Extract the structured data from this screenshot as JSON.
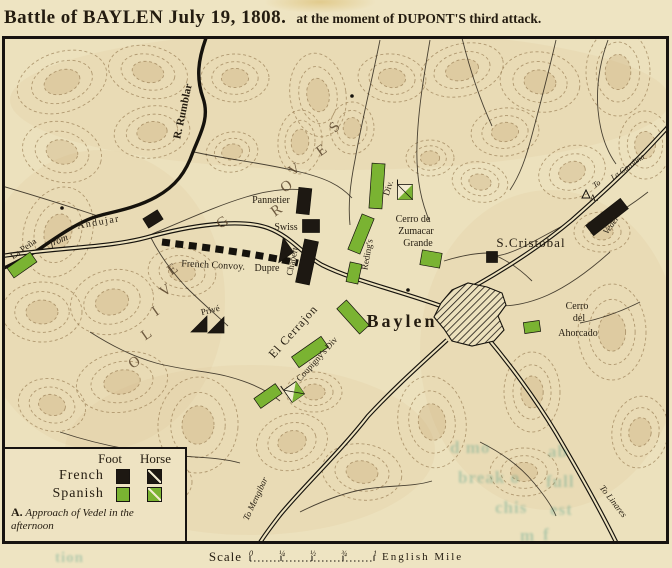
{
  "title": {
    "main": "Battle of BAYLEN July 19, 1808.",
    "sub": "at the moment of DUPONT'S third attack."
  },
  "colors": {
    "paper": "#ece1bd",
    "ink": "#15120c",
    "label_ink": "#241c10",
    "hill_ink": "#5a452c",
    "terrain_stroke": "#8d6f45",
    "terrain_fill": "#c2a26e",
    "french_black": "#1d1812",
    "spanish_green": "#7ab332",
    "bleed_teal": "#2f8f7d"
  },
  "legend": {
    "col_foot": "Foot",
    "col_horse": "Horse",
    "rows": [
      {
        "label": "French",
        "color": "#1d1812"
      },
      {
        "label": "Spanish",
        "color": "#7ab332"
      }
    ],
    "note_marker": "A.",
    "note_line1": "Approach of Vedel in the",
    "note_line2": "afternoon"
  },
  "scale_bar": {
    "label": "Scale",
    "ticks": [
      "0",
      "¼",
      "½",
      "¾",
      "1"
    ],
    "unit": "English Mile"
  },
  "map": {
    "hills": [
      [
        62,
        82,
        46,
        30,
        -18
      ],
      [
        148,
        72,
        40,
        26,
        12
      ],
      [
        235,
        78,
        34,
        24,
        0
      ],
      [
        318,
        95,
        28,
        42,
        -8
      ],
      [
        392,
        78,
        34,
        24,
        6
      ],
      [
        462,
        70,
        42,
        26,
        -14
      ],
      [
        540,
        82,
        40,
        30,
        8
      ],
      [
        618,
        72,
        32,
        44,
        0
      ],
      [
        645,
        145,
        26,
        34,
        0
      ],
      [
        505,
        132,
        34,
        24,
        -6
      ],
      [
        572,
        172,
        34,
        26,
        -18
      ],
      [
        480,
        182,
        28,
        20,
        10
      ],
      [
        430,
        158,
        24,
        18,
        0
      ],
      [
        300,
        142,
        22,
        32,
        4
      ],
      [
        232,
        152,
        26,
        20,
        -10
      ],
      [
        62,
        152,
        40,
        30,
        14
      ],
      [
        152,
        132,
        38,
        26,
        -8
      ],
      [
        58,
        232,
        34,
        46,
        18
      ],
      [
        42,
        312,
        40,
        30,
        0
      ],
      [
        112,
        302,
        42,
        32,
        -14
      ],
      [
        182,
        272,
        34,
        24,
        8
      ],
      [
        122,
        382,
        46,
        30,
        -10
      ],
      [
        52,
        405,
        34,
        26,
        14
      ],
      [
        198,
        425,
        40,
        48,
        4
      ],
      [
        292,
        442,
        36,
        28,
        -16
      ],
      [
        362,
        472,
        40,
        28,
        8
      ],
      [
        152,
        482,
        40,
        26,
        0
      ],
      [
        314,
        392,
        28,
        20,
        0
      ],
      [
        432,
        422,
        34,
        46,
        -8
      ],
      [
        532,
        392,
        28,
        40,
        0
      ],
      [
        612,
        332,
        34,
        48,
        0
      ],
      [
        640,
        432,
        28,
        36,
        8
      ],
      [
        524,
        472,
        34,
        24,
        0
      ],
      [
        602,
        232,
        28,
        20,
        0
      ],
      [
        352,
        128,
        22,
        26,
        0
      ]
    ],
    "river": {
      "name": "R. Rumblar",
      "d": "M206,38 C198,60 196,78 203,98 C210,118 200,134 193,152 C186,172 176,186 156,197 C136,208 116,211 98,216 C80,221 58,236 38,250 C22,260 10,265 2,269"
    },
    "roads": [
      {
        "name": "road-from-andujar",
        "d": "M2,256 C60,247 112,248 152,236 C205,222 246,220 268,228 C292,237 302,254 322,265 C352,280 396,290 441,306"
      },
      {
        "name": "road-to-la-carolina",
        "d": "M450,299 C492,278 540,247 572,220 C598,197 626,172 654,142 L668,127"
      },
      {
        "name": "road-to-linares",
        "d": "M468,316 C498,348 532,393 556,433 C576,467 600,509 618,546"
      },
      {
        "name": "road-to-mengibar",
        "d": "M447,340 C420,365 396,386 368,416 C340,452 302,488 280,515 C270,528 263,537 258,546"
      }
    ],
    "streams": [
      "M194,152 C230,160 265,163 300,172 C325,178 340,185 352,198",
      "M380,40 C372,80 362,120 355,160 C350,185 348,205 350,225",
      "M430,40 C424,75 418,110 417,145 C416,175 420,200 430,222",
      "M556,40 C548,75 540,105 532,135 C526,158 520,175 510,190",
      "M608,40 C600,62 596,86 598,110 C600,132 606,150 616,164",
      "M648,192 C630,206 614,216 600,223",
      "M610,252 C590,270 570,285 548,295 C530,303 514,306 500,306",
      "M640,302 C620,312 600,319 580,323",
      "M90,332 C112,346 132,356 156,363 C182,370 206,371 226,376 C250,382 268,391 280,401",
      "M60,432 C90,442 122,449 152,453 C186,458 216,456 240,463",
      "M100,546 C120,514 150,486 180,462",
      "M300,512 C320,502 342,493 366,489 C392,485 412,487 432,481",
      "M480,442 C500,452 520,466 534,483 C544,495 552,506 556,516",
      "M152,234 C186,220 216,206 246,197 C266,191 286,188 303,190",
      "M2,186 C36,196 68,206 98,216",
      "M150,236 C160,256 172,272 186,287 C200,301 214,313 228,326",
      "M444,261 C460,256 476,253 489,253",
      "M489,253 C506,259 520,269 532,281",
      "M574,220 C556,229 539,239 523,247 C506,255 496,257 489,256",
      "M462,38 C470,70 480,100 492,126"
    ],
    "convoy": {
      "name": "french-convoy-dashes",
      "d": "M162,242 C200,247 240,251 298,263"
    },
    "town": {
      "name": "Baylen-town",
      "points": "441,303 452,290 468,283 487,287 502,293 506,305 498,316 504,330 494,341 472,346 452,341 444,329 434,317"
    },
    "units": [
      {
        "name": "pannetier-unit",
        "type": "foot",
        "side": "french",
        "x": 304,
        "y": 201,
        "w": 13,
        "h": 26,
        "rot": 6
      },
      {
        "name": "swiss-unit",
        "type": "foot",
        "side": "french",
        "x": 311,
        "y": 226,
        "w": 17,
        "h": 13,
        "rot": 0
      },
      {
        "name": "chabert-unit",
        "type": "foot",
        "side": "french",
        "x": 307,
        "y": 262,
        "w": 14,
        "h": 44,
        "rot": 12
      },
      {
        "name": "road-junction-unit",
        "type": "foot",
        "side": "french",
        "x": 153,
        "y": 219,
        "w": 17,
        "h": 11,
        "rot": -32
      },
      {
        "name": "vedel-unit",
        "type": "foot",
        "side": "french",
        "x": 607,
        "y": 217,
        "w": 44,
        "h": 13,
        "rot": -38
      },
      {
        "name": "dupre-unit",
        "type": "tri",
        "side": "french",
        "x": 281,
        "y": 250,
        "s": 18,
        "rot": -35
      },
      {
        "name": "prive-cavalry-1",
        "type": "tri",
        "side": "french",
        "x": 199,
        "y": 324,
        "s": 16,
        "rot": 0
      },
      {
        "name": "prive-cavalry-2",
        "type": "tri",
        "side": "french",
        "x": 216,
        "y": 325,
        "s": 16,
        "rot": 0
      },
      {
        "name": "s-cristobal-building",
        "type": "foot",
        "side": "french",
        "x": 492,
        "y": 257,
        "w": 11,
        "h": 11,
        "rot": 0
      },
      {
        "name": "la-pena-unit",
        "type": "foot",
        "side": "spanish",
        "x": 22,
        "y": 265,
        "w": 28,
        "h": 12,
        "rot": -35
      },
      {
        "name": "reding-unit-1",
        "type": "foot",
        "side": "spanish",
        "x": 377,
        "y": 186,
        "w": 13,
        "h": 45,
        "rot": 4
      },
      {
        "name": "reding-cavalry",
        "type": "cav",
        "side": "spanish",
        "x": 405,
        "y": 192,
        "s": 15,
        "rot": 0
      },
      {
        "name": "reding-unit-2",
        "type": "foot",
        "side": "spanish",
        "x": 361,
        "y": 234,
        "w": 13,
        "h": 38,
        "rot": 22
      },
      {
        "name": "reding-unit-3",
        "type": "foot",
        "side": "spanish",
        "x": 354,
        "y": 273,
        "w": 12,
        "h": 20,
        "rot": 12
      },
      {
        "name": "zumacar-unit",
        "type": "foot",
        "side": "spanish",
        "x": 431,
        "y": 259,
        "w": 20,
        "h": 15,
        "rot": 10
      },
      {
        "name": "baylen-west-unit",
        "type": "foot",
        "side": "spanish",
        "x": 353,
        "y": 317,
        "w": 13,
        "h": 34,
        "rot": -42
      },
      {
        "name": "coupigny-unit-1",
        "type": "foot",
        "side": "spanish",
        "x": 310,
        "y": 352,
        "w": 36,
        "h": 13,
        "rot": -35
      },
      {
        "name": "coupigny-unit-2",
        "type": "foot",
        "side": "spanish",
        "x": 268,
        "y": 396,
        "w": 26,
        "h": 12,
        "rot": -35
      },
      {
        "name": "coupigny-cavalry",
        "type": "cav",
        "side": "spanish",
        "x": 294,
        "y": 392,
        "s": 15,
        "rot": -35
      },
      {
        "name": "ahorcado-unit",
        "type": "foot",
        "side": "spanish",
        "x": 532,
        "y": 327,
        "w": 16,
        "h": 11,
        "rot": -8
      }
    ],
    "dots": [
      [
        408,
        290
      ],
      [
        62,
        208
      ],
      [
        352,
        96
      ]
    ],
    "marker_a": {
      "x": 586,
      "y": 194
    },
    "labels": [
      {
        "text": "R. Rumblar",
        "x": 186,
        "y": 112,
        "rot": -78,
        "size": 11,
        "weight": "bold",
        "name": "label-r-rumblar"
      },
      {
        "text": "from",
        "x": 60,
        "y": 243,
        "rot": -22,
        "size": 10,
        "style": "italic",
        "name": "label-from"
      },
      {
        "text": "Andujar",
        "x": 99,
        "y": 225,
        "rot": -10,
        "size": 10,
        "ls": 1.5,
        "name": "label-andujar"
      },
      {
        "text": "La Peña",
        "x": 25,
        "y": 251,
        "rot": -35,
        "size": 9,
        "name": "label-la-pena"
      },
      {
        "text": "French Convoy.",
        "x": 213,
        "y": 268,
        "rot": 3,
        "size": 10,
        "name": "label-french-convoy"
      },
      {
        "text": "Dupre",
        "x": 267,
        "y": 271,
        "rot": 0,
        "size": 10,
        "name": "label-dupre"
      },
      {
        "text": "Chabert",
        "x": 295,
        "y": 262,
        "rot": -78,
        "size": 9,
        "name": "label-chabert"
      },
      {
        "text": "Swiss",
        "x": 286,
        "y": 230,
        "rot": 0,
        "size": 10,
        "name": "label-swiss"
      },
      {
        "text": "Pannetier",
        "x": 271,
        "y": 203,
        "rot": 0,
        "size": 10,
        "name": "label-pannetier"
      },
      {
        "text": "Privé",
        "x": 211,
        "y": 313,
        "rot": -14,
        "size": 9,
        "name": "label-prive"
      },
      {
        "text": "O",
        "x": 137,
        "y": 366,
        "rot": -35,
        "size": 15,
        "cls": "hill",
        "name": "label-olive-o"
      },
      {
        "text": "L",
        "x": 149,
        "y": 338,
        "rot": -35,
        "size": 15,
        "cls": "hill",
        "name": "label-olive-l"
      },
      {
        "text": "I",
        "x": 158,
        "y": 315,
        "rot": -35,
        "size": 15,
        "cls": "hill",
        "name": "label-olive-i"
      },
      {
        "text": "V",
        "x": 168,
        "y": 294,
        "rot": -35,
        "size": 15,
        "cls": "hill",
        "name": "label-olive-v"
      },
      {
        "text": "E",
        "x": 175,
        "y": 273,
        "rot": -35,
        "size": 15,
        "cls": "hill",
        "name": "label-olive-e"
      },
      {
        "text": "G",
        "x": 225,
        "y": 226,
        "rot": -35,
        "size": 15,
        "cls": "hill",
        "name": "label-groves-g"
      },
      {
        "text": "R",
        "x": 279,
        "y": 214,
        "rot": -35,
        "size": 15,
        "cls": "hill",
        "name": "label-groves-r"
      },
      {
        "text": "O",
        "x": 289,
        "y": 190,
        "rot": -35,
        "size": 15,
        "cls": "hill",
        "name": "label-groves-o"
      },
      {
        "text": "V",
        "x": 297,
        "y": 173,
        "rot": -35,
        "size": 15,
        "cls": "hill",
        "name": "label-groves-v"
      },
      {
        "text": "E",
        "x": 324,
        "y": 154,
        "rot": -35,
        "size": 15,
        "cls": "hill",
        "name": "label-groves-e"
      },
      {
        "text": "S",
        "x": 338,
        "y": 130,
        "rot": -50,
        "size": 15,
        "cls": "hill",
        "name": "label-groves-s"
      },
      {
        "text": "Reding's",
        "x": 370,
        "y": 255,
        "rot": -80,
        "size": 9,
        "name": "label-redings"
      },
      {
        "text": "Div.",
        "x": 391,
        "y": 189,
        "rot": -72,
        "size": 9,
        "name": "label-redings-div"
      },
      {
        "text": "Cerro de",
        "x": 413,
        "y": 222,
        "rot": 0,
        "size": 10,
        "name": "label-cerro-de"
      },
      {
        "text": "Zumacar",
        "x": 416,
        "y": 234,
        "rot": 0,
        "size": 10,
        "name": "label-zumacar"
      },
      {
        "text": "Grande",
        "x": 418,
        "y": 246,
        "rot": 0,
        "size": 10,
        "name": "label-grande"
      },
      {
        "text": "S.Cristobal",
        "x": 531,
        "y": 247,
        "rot": 0,
        "size": 13,
        "ls": 1,
        "name": "label-s-cristobal"
      },
      {
        "text": "Baylen",
        "x": 402,
        "y": 327,
        "rot": 0,
        "size": 18,
        "weight": "bold",
        "ls": 3,
        "name": "label-baylen"
      },
      {
        "text": "El Cerrajon",
        "x": 296,
        "y": 334,
        "rot": -48,
        "size": 12,
        "ls": 1,
        "name": "label-el-cerrajon"
      },
      {
        "text": "Coupigny's Div",
        "x": 319,
        "y": 361,
        "rot": -48,
        "size": 9,
        "name": "label-coupignys-div"
      },
      {
        "text": "Cerro",
        "x": 577,
        "y": 309,
        "rot": 0,
        "size": 10,
        "name": "label-cerro"
      },
      {
        "text": "del",
        "x": 579,
        "y": 321,
        "rot": 0,
        "size": 10,
        "name": "label-del"
      },
      {
        "text": "Ahorcado",
        "x": 578,
        "y": 336,
        "rot": 0,
        "size": 10,
        "name": "label-ahorcado"
      },
      {
        "text": "To",
        "x": 598,
        "y": 186,
        "rot": -35,
        "size": 8,
        "style": "italic",
        "name": "label-to"
      },
      {
        "text": "La Carolina",
        "x": 629,
        "y": 169,
        "rot": -35,
        "size": 8,
        "style": "italic",
        "name": "label-la-carolina"
      },
      {
        "text": "Vedel",
        "x": 613,
        "y": 227,
        "rot": -55,
        "size": 9,
        "style": "italic",
        "name": "label-vedel"
      },
      {
        "text": "A.",
        "x": 594,
        "y": 201,
        "rot": 0,
        "size": 9,
        "name": "label-marker-a"
      },
      {
        "text": "To Linares",
        "x": 611,
        "y": 503,
        "rot": 52,
        "size": 9,
        "style": "italic",
        "name": "label-to-linares"
      },
      {
        "text": "To Mengibar",
        "x": 258,
        "y": 500,
        "rot": -65,
        "size": 9,
        "style": "italic",
        "name": "label-to-mengibar"
      }
    ]
  },
  "bleed_text": [
    {
      "t": "d mo",
      "x": 450,
      "y": 438,
      "size": 17
    },
    {
      "t": "break o",
      "x": 458,
      "y": 468,
      "size": 17
    },
    {
      "t": "chis",
      "x": 495,
      "y": 498,
      "size": 17
    },
    {
      "t": "m",
      "x": 520,
      "y": 526,
      "size": 17
    },
    {
      "t": "ab",
      "x": 548,
      "y": 442,
      "size": 17
    },
    {
      "t": "full",
      "x": 546,
      "y": 472,
      "size": 17
    },
    {
      "t": "est",
      "x": 550,
      "y": 500,
      "size": 17
    },
    {
      "t": "f",
      "x": 543,
      "y": 525,
      "size": 17
    },
    {
      "t": "tion",
      "x": 55,
      "y": 550,
      "size": 15
    }
  ]
}
